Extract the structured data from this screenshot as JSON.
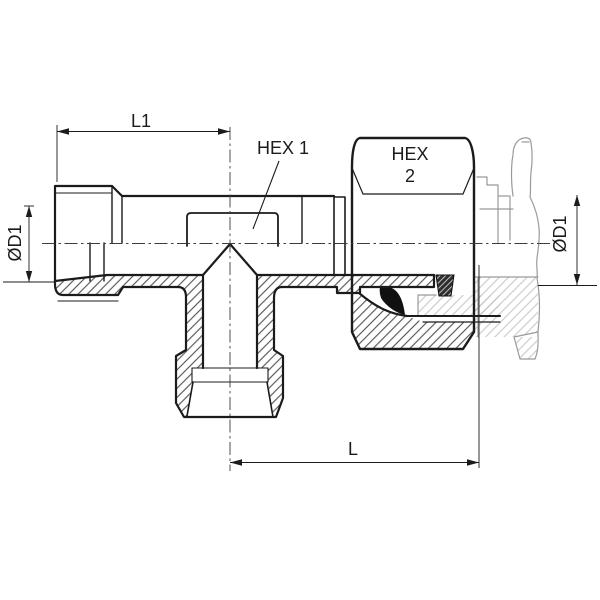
{
  "drawing": {
    "kind": "technical-section-drawing",
    "subject": "adjustable barrel tee tube fitting with swivel nut, shown half-sectioned with phantom mating stud",
    "labels": {
      "dim_l1": "L1",
      "dim_l": "L",
      "dim_od1_left": "ØD1",
      "dim_od1_right": "ØD1",
      "callout_hex1": "HEX 1",
      "callout_hex2_line1": "HEX",
      "callout_hex2_line2": "2"
    },
    "colors": {
      "line": "#1b1b1b",
      "hatch": "#3d3d3d",
      "phantom": "#9a9a9a",
      "phantom_hatch": "#c3c3c3",
      "seal": "#111111",
      "background": "#ffffff"
    }
  }
}
